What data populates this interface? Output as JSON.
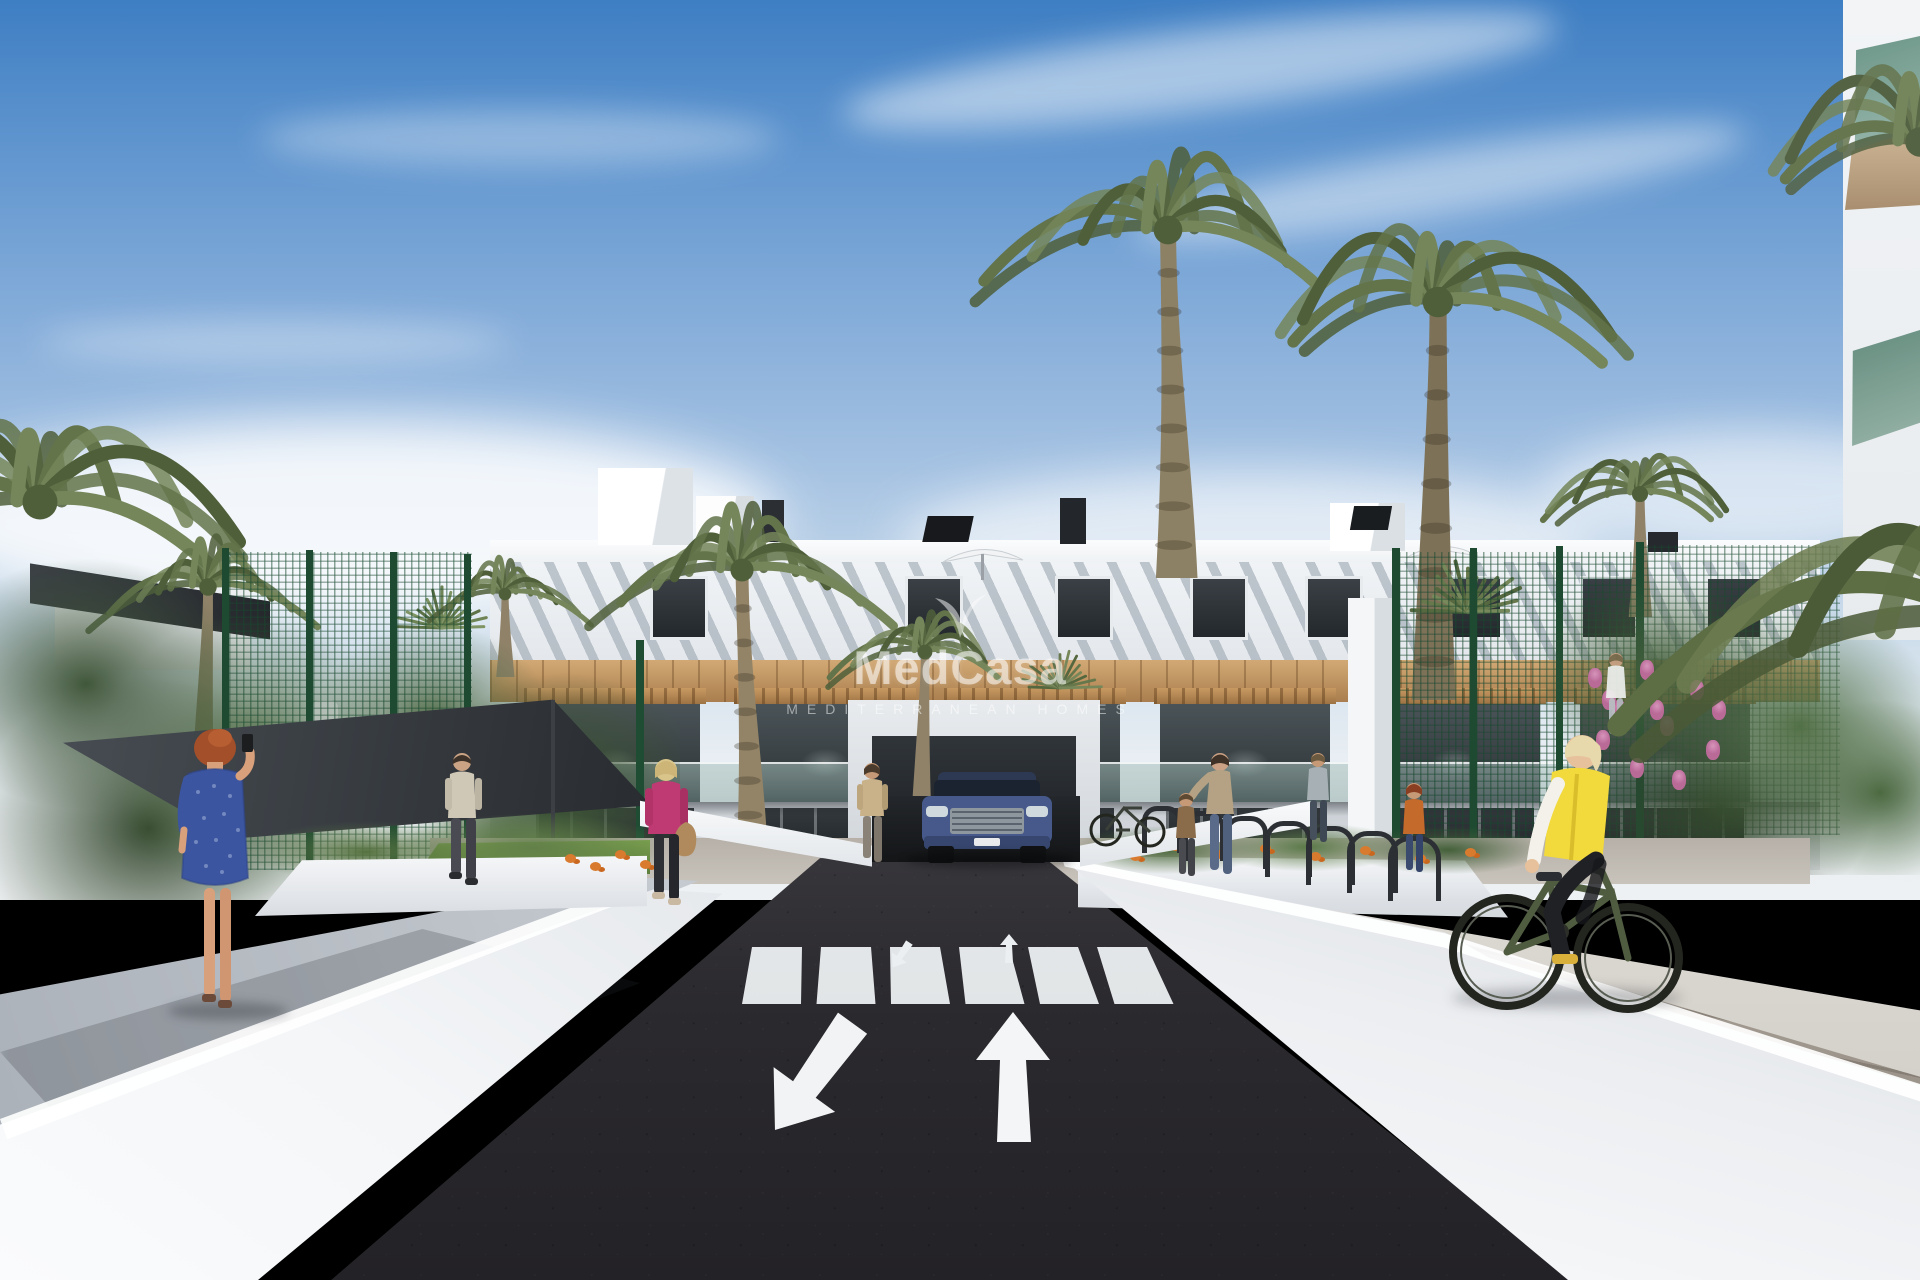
{
  "watermark": {
    "logo": "palm-leaf-mark",
    "brand": "MedCasa",
    "tagline": "MEDITERRANEAN HOMES"
  },
  "scene": {
    "setting": "3D architectural rendering of a white Mediterranean apartment complex street view",
    "sky": "clear blue sky with thin white clouds",
    "road_marking_arrows": [
      "toward-viewer",
      "away-from-viewer"
    ],
    "crosswalk_stripes": 6,
    "vehicle": "blue SUV exiting underground car park ramp",
    "people_visible": 11,
    "bicycles": 2
  },
  "colors": {
    "sky_top": "#3e7ec3",
    "sky_horizon": "#eef1f3",
    "asphalt": "#2a292d",
    "wall_white": "#f1f3f5",
    "wood_cladding": "#bd8f5e",
    "fence_green": "#2f6b49",
    "palm_green": "#63744a",
    "grass": "#79a04e",
    "car_blue": "#46598a",
    "vest_yellow": "#f2d93c",
    "jacket_magenta": "#bf3a72",
    "dress_blue": "#3c55a0",
    "flower_orange": "#d97b2e",
    "flower_pink": "#c886ab"
  }
}
